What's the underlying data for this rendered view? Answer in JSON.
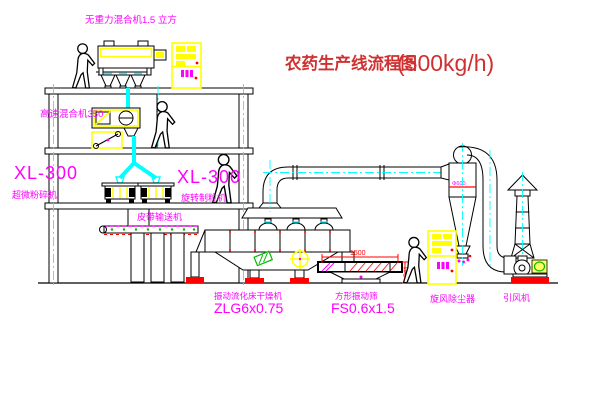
{
  "title": {
    "text_cn": "农药生产线流程图",
    "capacity": "(500kg/h)"
  },
  "equipment_labels": {
    "top_mixer": "无重力混合机1.5 立方",
    "high_speed_mixer": "高速混合机350",
    "pulverizer_model": "XL-300",
    "pulverizer_name": "超微粉碎机",
    "granulator_model": "XL-300",
    "granulator_name": "旋转制粒机",
    "belt_conveyor": "皮带输送机",
    "dryer_name": "振动流化床干燥机",
    "dryer_model": "ZLG6x0.75",
    "screen_name": "方形振动筛",
    "screen_model": "FS0.6x1.5",
    "cyclone_name": "旋风除尘器",
    "fan_name": "引风机"
  },
  "dimensions": {
    "screen_length": "1500",
    "screen_height": "541",
    "cyclone_marking": "Φ600"
  },
  "colors": {
    "background": "#ffffff",
    "structure_black": "#000000",
    "equipment_yellow": "#ffff00",
    "pipe_cyan": "#00ffff",
    "label_magenta": "#ff00ff",
    "title_red": "#d03030",
    "accent_red": "#ff0000",
    "accent_green": "#00bb00"
  }
}
